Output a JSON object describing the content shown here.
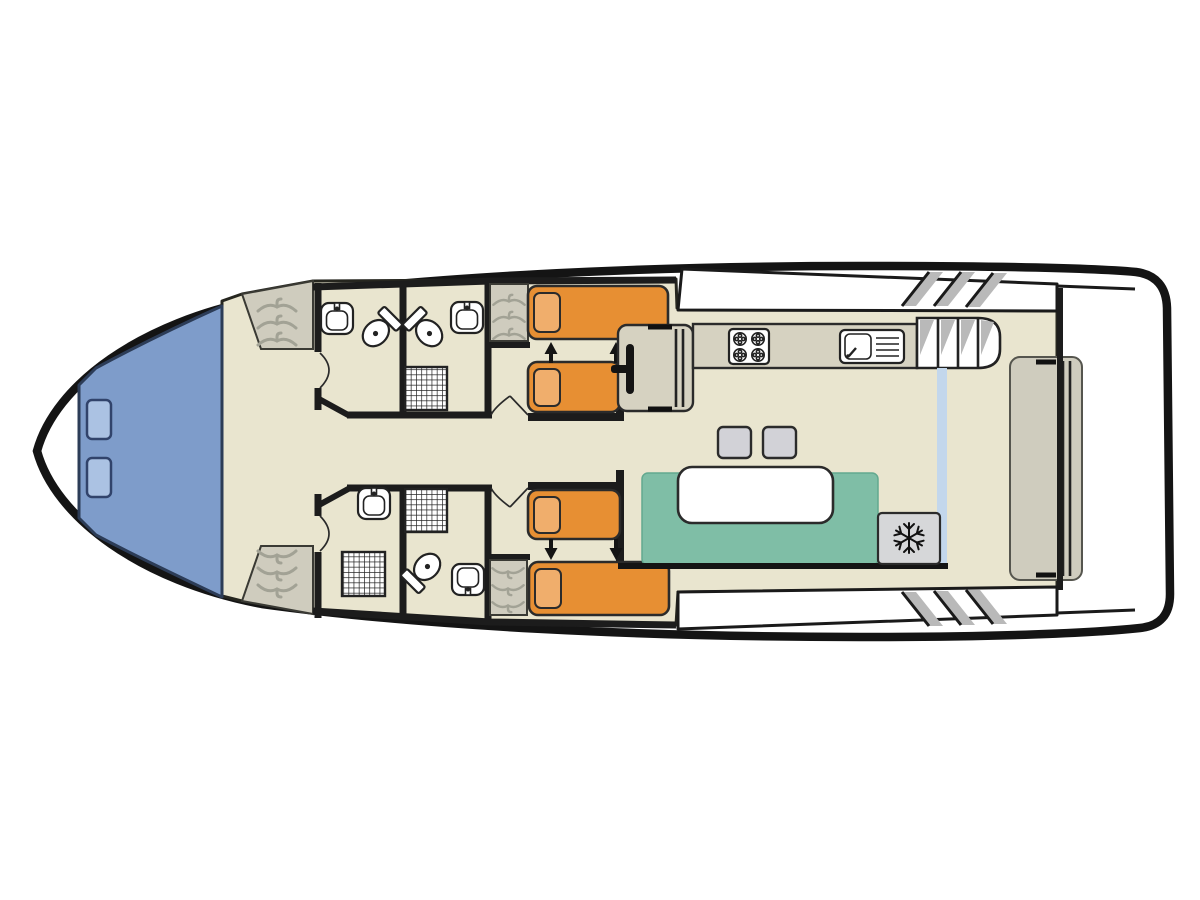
{
  "diagram": {
    "type": "houseboat-floor-plan",
    "orientation": "bow-left-stern-right",
    "palette": {
      "hull_outline": "#141414",
      "deck_white": "#ffffff",
      "interior_cream": "#e9e5cf",
      "wall_black": "#1c1c1c",
      "counter_tan": "#d6d2c1",
      "wardrobe_gray": "#cfccbe",
      "hanger_gray": "#a2a295",
      "bow_deck_blue": "#7e9cca",
      "bow_hatch_blue": "#abc2e3",
      "bed_orange": "#e78f33",
      "pillow_orange": "#f0ae6c",
      "bench_teal": "#7fbea6",
      "table_white": "#ffffff",
      "stool_gray": "#d2d2d7",
      "freezer_gray": "#d6d7d9",
      "accent_strip_blue": "#c3d7ec",
      "step_shadow_gray": "#b9b9b9"
    },
    "features": {
      "bow_deck": {
        "hatch_count": 2
      },
      "foyer": {
        "wardrobes": 2,
        "hangers_per_wardrobe": 3
      },
      "bathrooms": [
        {
          "position": "top-left",
          "fixtures": [
            "sink",
            "toilet"
          ]
        },
        {
          "position": "top-right",
          "fixtures": [
            "sink",
            "toilet",
            "shower"
          ]
        },
        {
          "position": "bottom-left",
          "fixtures": [
            "sink",
            "shower"
          ]
        },
        {
          "position": "bottom-right",
          "fixtures": [
            "shower",
            "toilet",
            "sink"
          ]
        }
      ],
      "cabins": [
        {
          "position": "top",
          "beds": 2,
          "pillows": 2,
          "slide_arrows": "up",
          "wardrobe": true,
          "dresser": true
        },
        {
          "position": "bottom",
          "beds": 2,
          "pillows": 2,
          "slide_arrows": "down",
          "wardrobe": true
        }
      ],
      "galley": {
        "stove_burners": 4,
        "sink_basins": 1,
        "drainer_lines": 4
      },
      "saloon": {
        "stools": 2,
        "dining_table": 1,
        "bench_seating": true,
        "freezer_icon": "snowflake"
      },
      "decks": {
        "top_walkway_steps": 3,
        "bottom_walkway_steps": 3,
        "flybridge_stair_treads": 4
      },
      "stern": {
        "bench": true,
        "bulkhead": true
      }
    }
  }
}
